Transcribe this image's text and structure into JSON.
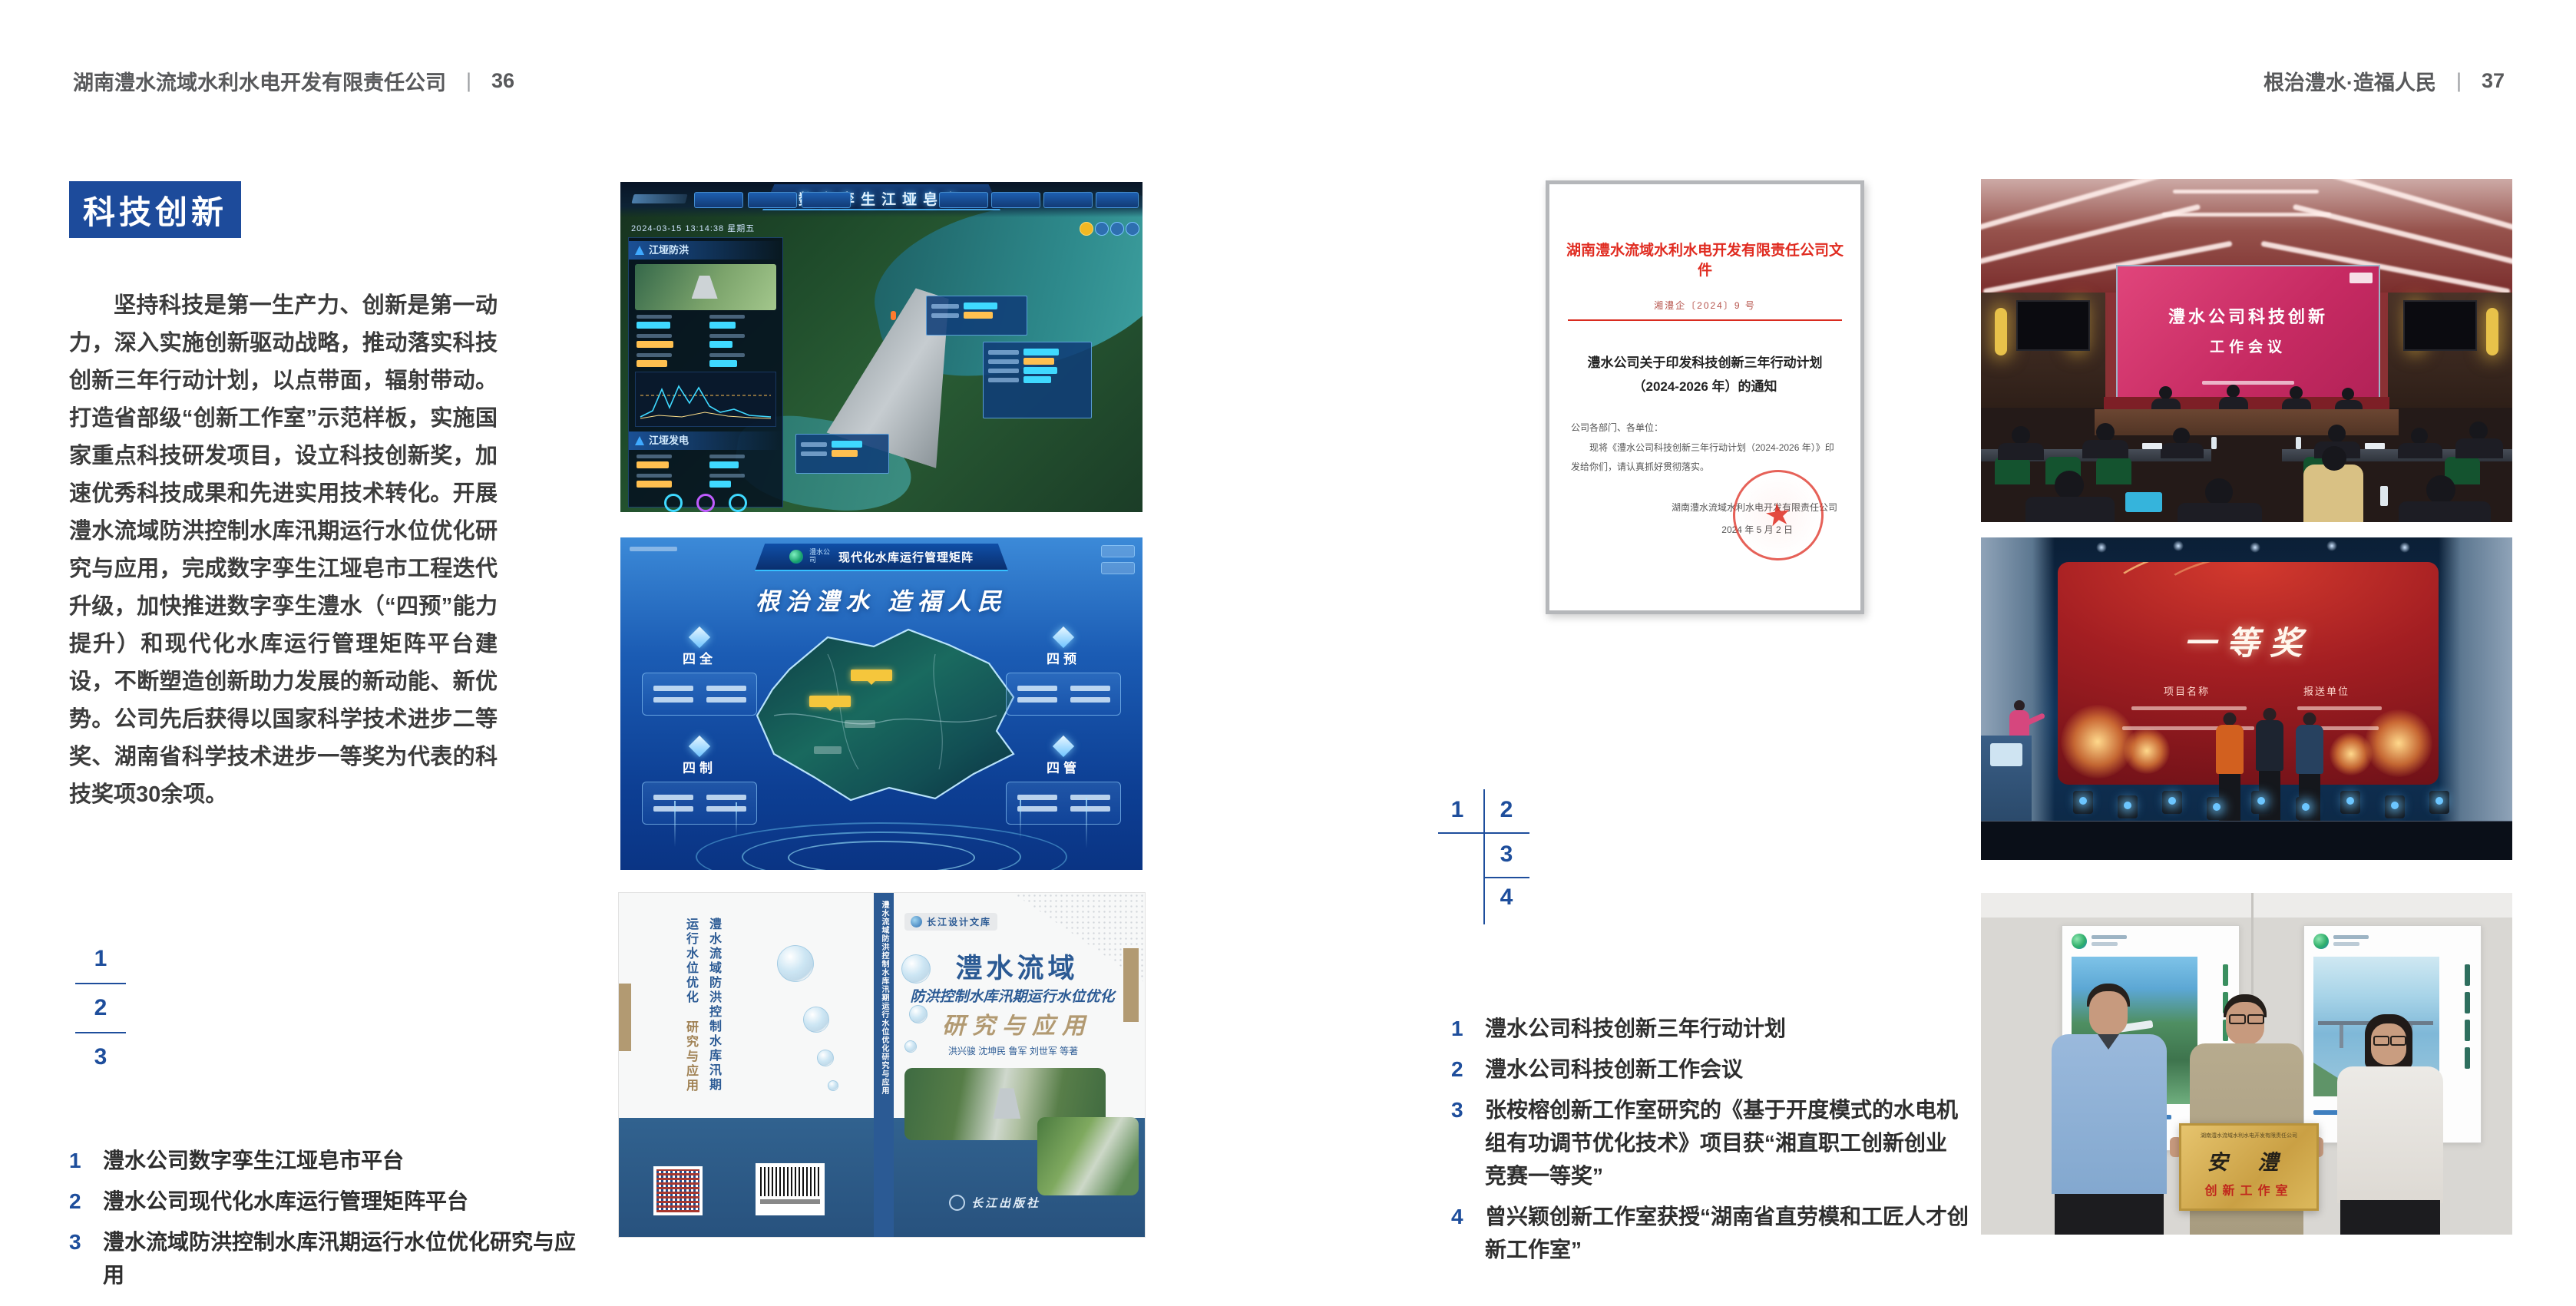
{
  "left_page": {
    "header": {
      "company": "湖南澧水流域水利水电开发有限责任公司",
      "sep": "|",
      "page": "36"
    },
    "badge": "科技创新",
    "paragraph": "坚持科技是第一生产力、创新是第一动力，深入实施创新驱动战略，推动落实科技创新三年行动计划，以点带面，辐射带动。打造省部级“创新工作室”示范样板，实施国家重点科技研发项目，设立科技创新奖，加速优秀科技成果和先进实用技术转化。开展澧水流域防洪控制水库汛期运行水位优化研究与应用，完成数字孪生江垭皂市工程迭代升级，加快推进数字孪生澧水（“四预”能力提升）和现代化水库运行管理矩阵平台建设，不断塑造创新助力发展的新动能、新优势。公司先后获得以国家科学技术进步二等奖、湖南省科学技术进步一等奖为代表的科技奖项30余项。",
    "index_numbers": [
      "1",
      "2",
      "3"
    ],
    "captions": [
      {
        "num": "1",
        "text": "澧水公司数字孪生江垭皂市平台"
      },
      {
        "num": "2",
        "text": "澧水公司现代化水库运行管理矩阵平台"
      },
      {
        "num": "3",
        "text": "澧水流域防洪控制水库汛期运行水位优化研究与应用"
      }
    ]
  },
  "right_page": {
    "header": {
      "title": "根治澧水·造福人民",
      "sep": "|",
      "page": "37"
    },
    "index_numbers": [
      "1",
      "2",
      "3",
      "4"
    ],
    "captions": [
      {
        "num": "1",
        "text": "澧水公司科技创新三年行动计划"
      },
      {
        "num": "2",
        "text": "澧水公司科技创新工作会议"
      },
      {
        "num": "3",
        "text": "张桉榕创新工作室研究的《基于开度模式的水电机组有功调节优化技术》项目获“湘直职工创新创业竞赛一等奖”"
      },
      {
        "num": "4",
        "text": "曾兴颖创新工作室获授“湖南省直劳模和工匠人才创新工作室”"
      }
    ]
  },
  "fig_dashboard": {
    "title": "数字孪生江垭皂市",
    "datetime": "2024-03-15 13:14:38 星期五",
    "panel_flood": "江垭防洪",
    "panel_power": "江垭发电"
  },
  "fig_matrix": {
    "logo_text": "澧水公司",
    "title": "现代化水库运行管理矩阵",
    "slogan": "根治澧水 造福人民",
    "quad_titles": [
      "四全",
      "四预",
      "四制",
      "四管"
    ]
  },
  "fig_book": {
    "series": "长江设计文库",
    "title_main": "澧水流域",
    "title_sub": "防洪控制水库汛期运行水位优化",
    "title_tail": "研究与应用",
    "authors": "洪兴骏 沈坤民 鲁军 刘世军 等著",
    "publisher": "长江出版社",
    "spine_text": "澧水流域防洪控制水库汛期运行水位优化研究与应用",
    "back_title": "澧水流域防洪控制水库汛期运行水位优化",
    "back_tail": "研究与应用"
  },
  "fig_document": {
    "header": "湖南澧水流域水利水电开发有限责任公司文件",
    "doc_no": "湘澧企〔2024〕9 号",
    "title1": "澧水公司关于印发科技创新三年行动计划",
    "title2": "（2024-2026 年）的通知",
    "salutation": "公司各部门、各单位：",
    "body": "现将《澧水公司科技创新三年行动计划（2024-2026 年）》印发给你们，请认真抓好贯彻落实。",
    "signer": "湖南澧水流域水利水电开发有限责任公司",
    "date": "2024 年 5 月 2 日",
    "seal_star": "★"
  },
  "fig_meeting": {
    "screen_line1": "澧水公司科技创新",
    "screen_line2": "工作会议"
  },
  "fig_award": {
    "headline": "一等奖",
    "col_left": "项目名称",
    "col_right": "报送单位"
  },
  "fig_plaque": {
    "org_line": "湖南澧水流域水利水电开发有限责任公司",
    "name": "安  澧",
    "subtitle": "创新工作室"
  },
  "colors": {
    "accent_blue": "#1d4b9b",
    "doc_red": "#e02b20",
    "band_blue": "#31628f"
  }
}
